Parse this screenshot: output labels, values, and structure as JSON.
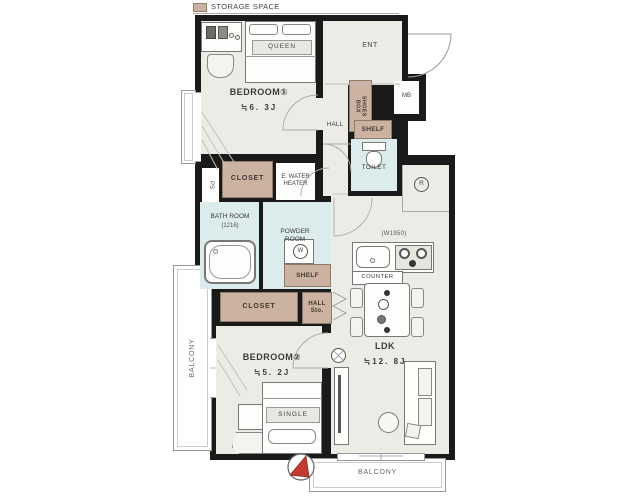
{
  "legend": {
    "label": "STORAGE SPACE"
  },
  "rooms": {
    "bedroom1": {
      "name": "BEDROOM①",
      "size": "≒6. 3J"
    },
    "bedroom2": {
      "name": "BEDROOM②",
      "size": "≒5. 2J"
    },
    "ldk": {
      "name": "LDK",
      "size": "≒12. 8J"
    },
    "entrance": {
      "name": "ENT"
    },
    "hall": {
      "name": "HALL"
    },
    "toilet": {
      "name": "TOILET"
    },
    "bathroom": {
      "name": "BATH ROOM",
      "size": "(1216)"
    },
    "powder_room": {
      "name": "POWDER\nROOM"
    }
  },
  "storage": {
    "shoes_box": "SHOES\nBOX",
    "shelf_toilet": "SHELF",
    "shelf_powder": "SHELF",
    "closet_bedroom1": "CLOSET",
    "closet_bedroom2": "CLOSET",
    "hall_storage": "HALL\nSto."
  },
  "utilities": {
    "meter_box": "MB",
    "pipe_space": "PS",
    "water_heater": "E. WATER\nHEATER",
    "washer_symbol": "W",
    "fridge_symbol": "R"
  },
  "kitchen": {
    "counter": "COUNTER",
    "width": "(W1950)"
  },
  "beds": {
    "queen": "QUEEN",
    "single": "SINGLE"
  },
  "balconies": {
    "left": "BALCONY",
    "bottom": "BALCONY"
  },
  "colors": {
    "wall": "#1a1a1a",
    "floor": "#edebe5",
    "wet_area": "#dcebeb",
    "storage": "#ccb2a1",
    "north_arrow": "#c23b2f"
  }
}
